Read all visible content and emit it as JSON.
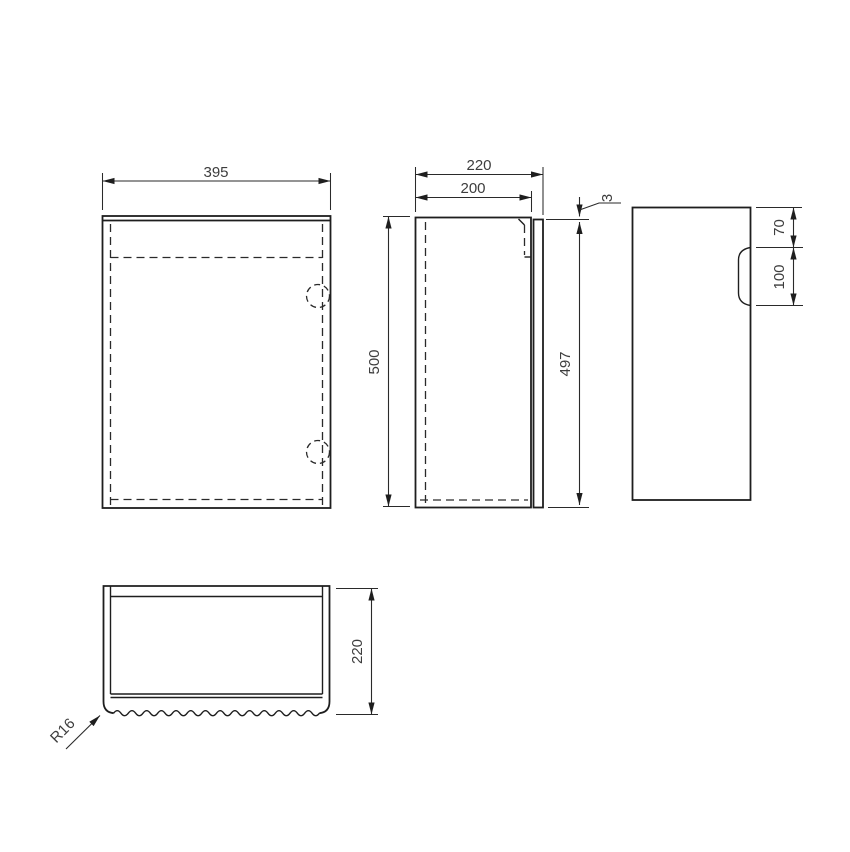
{
  "palette": {
    "background": "#ffffff",
    "line_color": "#1e1e1e",
    "dim_text_color": "#3d3d3d"
  },
  "views": {
    "front": {
      "width": "395"
    },
    "side_section": {
      "overall_depth": "220",
      "carcass_depth": "200",
      "overall_height": "500",
      "door_height": "497",
      "door_top_gap": "3"
    },
    "side_profile": {
      "handle_top_offset": "70",
      "handle_recess_height": "100"
    },
    "plan": {
      "overall_depth": "220",
      "corner_radius": "R16"
    }
  }
}
